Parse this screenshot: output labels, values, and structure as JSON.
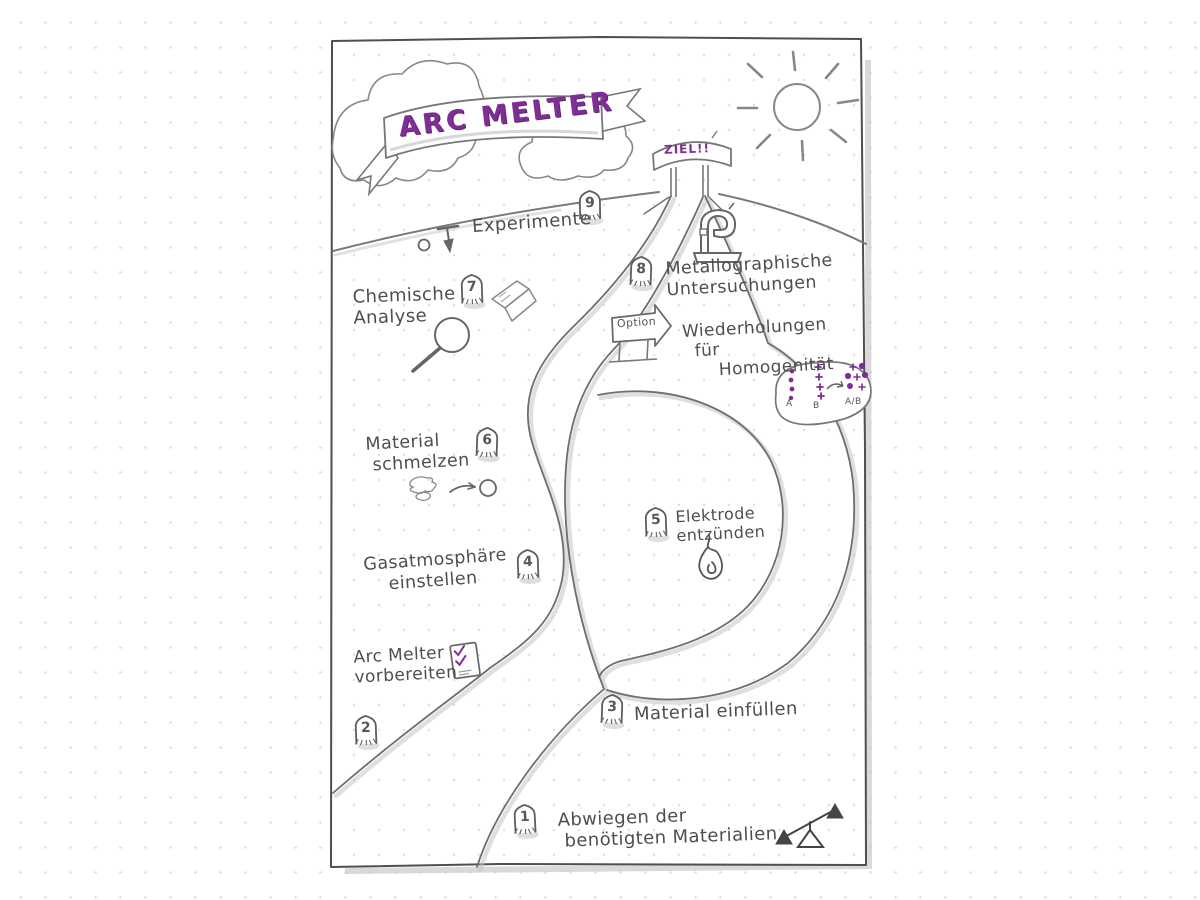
{
  "banner": {
    "title": "ARC MELTER"
  },
  "gate": {
    "label": "ZIEL!!"
  },
  "sign": {
    "label": "Option"
  },
  "steps": [
    {
      "number": "1",
      "label": "Abwiegen der\n benötigten Materialien"
    },
    {
      "number": "2",
      "label": "Arc Melter\nvorbereiten"
    },
    {
      "number": "3",
      "label": "Material einfüllen"
    },
    {
      "number": "4",
      "label": "Gasatmosphäre\n    einstellen"
    },
    {
      "number": "5",
      "label": "Elektrode\nentzünden"
    },
    {
      "number": "6",
      "label": "Material\n schmelzen"
    },
    {
      "number": "7",
      "label": "Chemische\nAnalyse"
    },
    {
      "number": "8",
      "label": "Metallographische\nUntersuchungen"
    },
    {
      "number": "9",
      "label": "Experimente"
    }
  ],
  "option_loop": {
    "label": "Wiederholungen\n  für\n      Homogenität",
    "mix_left": "A",
    "mix_mid": "B",
    "mix_right": "A/B"
  },
  "colors": {
    "ink": "#4e4e4e",
    "accent": "#7d2f96"
  }
}
